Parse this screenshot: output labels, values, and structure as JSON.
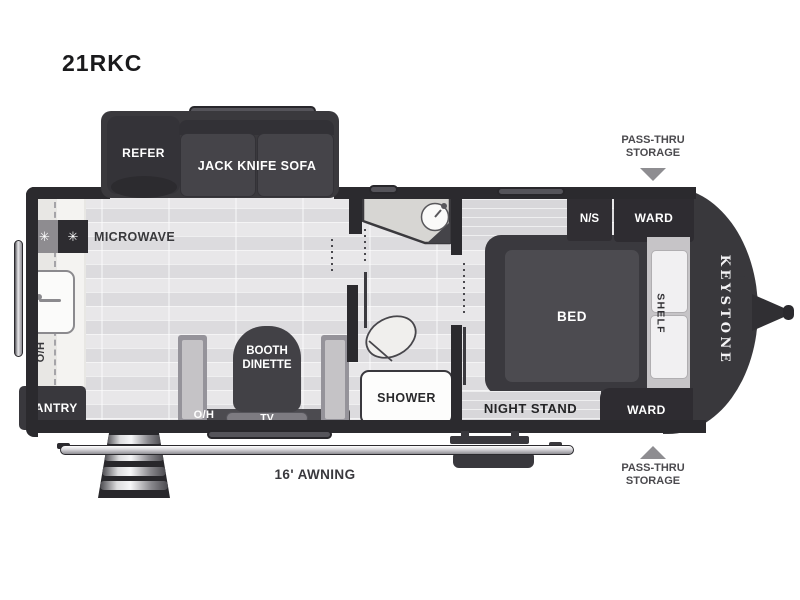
{
  "model": "21RKC",
  "brand": "KEYSTONE",
  "slide_out": {
    "refrigerator": "REFER",
    "sofa": "JACK KNIFE SOFA"
  },
  "kitchen": {
    "microwave": "MICROWAVE",
    "overhead_cabinet": "O/H",
    "pantry": "PANTRY",
    "burner_icon": "✳"
  },
  "dinette": {
    "name_line1": "BOOTH",
    "name_line2": "DINETTE",
    "overhead_cabinet": "O/H",
    "tv": "TV"
  },
  "bathroom": {
    "shower": "SHOWER"
  },
  "bedroom": {
    "bed": "BED",
    "shelf": "SHELF",
    "nightstand_abbr": "N/S",
    "wardrobe_top": "WARD",
    "wardrobe_bottom": "WARD",
    "night_stand": "NIGHT STAND"
  },
  "exterior": {
    "awning": "16' AWNING",
    "pass_thru": {
      "line1": "PASS-THRU",
      "line2": "STORAGE"
    }
  },
  "colors": {
    "wall": "#2b2a2e",
    "furniture_dark": "#3a393d",
    "floor_light": "#e8e7e9",
    "floor_shade": "#dcdbde",
    "bench": "#c5c3c6",
    "counter": "#f4f3f1",
    "annotation_text": "#4b4a4e",
    "arrow_gray": "#8e8d91",
    "label_text_light": "#ffffff",
    "title_text": "#1a1a1c"
  }
}
